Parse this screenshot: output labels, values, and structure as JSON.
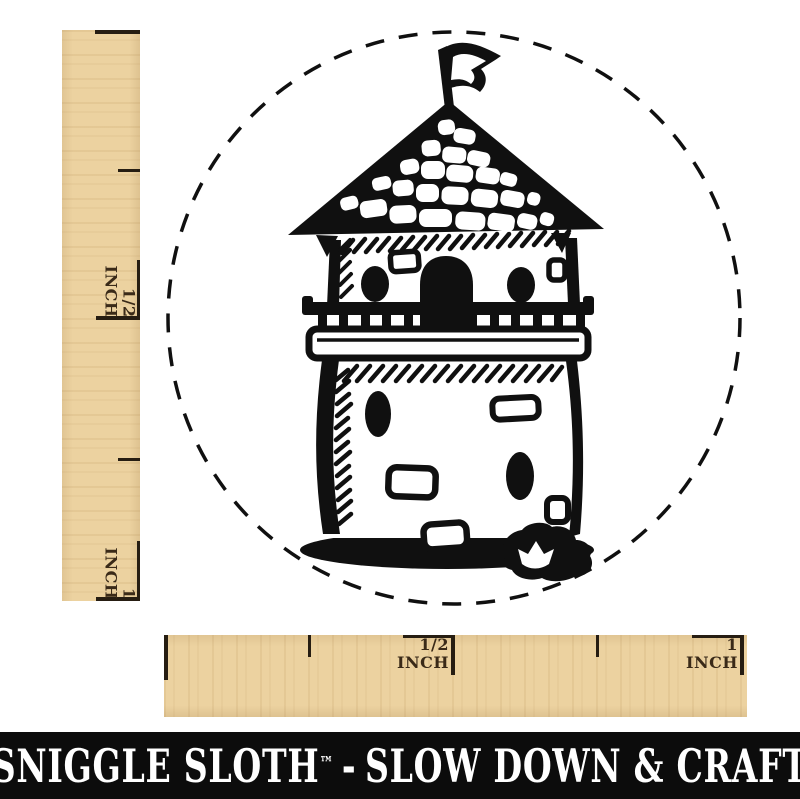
{
  "canvas": {
    "width": 800,
    "height": 799,
    "background": "#ffffff"
  },
  "stamp_design": {
    "subject": "stone castle tower with flag inside dashed circle",
    "ink_color": "#101010",
    "boundary": "dashed-circle"
  },
  "rulers": {
    "wood_color": "#ecd2a0",
    "tick_color": "#261d12",
    "label_color": "#3a2a18",
    "vertical": {
      "labels": [
        {
          "fraction": "1/2",
          "unit": "INCH"
        },
        {
          "fraction": "1",
          "unit": "INCH"
        }
      ]
    },
    "horizontal": {
      "labels": [
        {
          "fraction": "1/2",
          "unit": "INCH"
        },
        {
          "fraction": "1",
          "unit": "INCH"
        }
      ]
    }
  },
  "banner": {
    "background": "#0c0c0c",
    "text_color": "#ffffff",
    "brand": "SNIGGLE SLOTH",
    "trademark": "™",
    "separator": "-",
    "tagline": "SLOW DOWN & CRAFT",
    "full_text": "SNIGGLE SLOTH™ - SLOW DOWN & CRAFT"
  }
}
